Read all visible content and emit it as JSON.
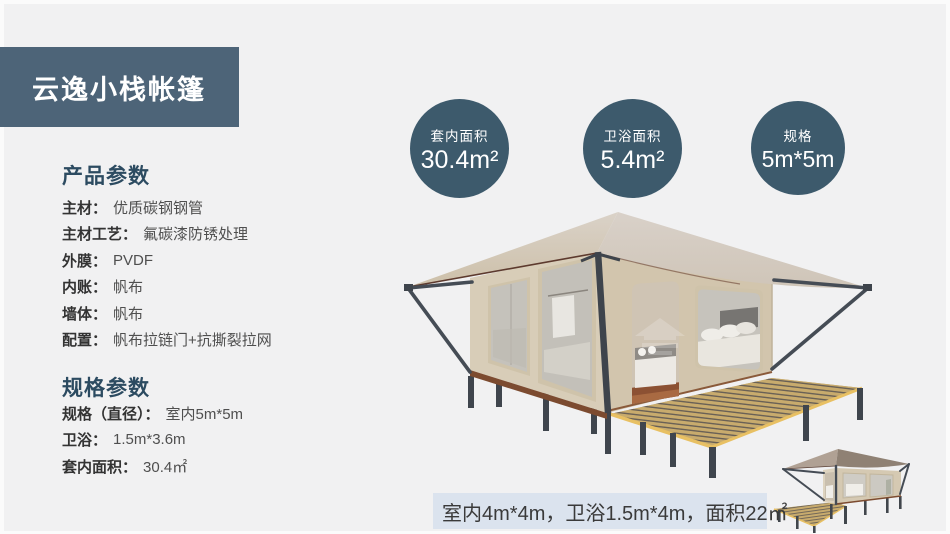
{
  "banner": {
    "title": "云逸小栈帐篷"
  },
  "product_params": {
    "heading": "产品参数",
    "items": [
      {
        "label": "主材：",
        "value": "优质碳钢钢管"
      },
      {
        "label": "主材工艺：",
        "value": "氟碳漆防锈处理"
      },
      {
        "label": "外膜：",
        "value": "PVDF"
      },
      {
        "label": "内账：",
        "value": "帆布"
      },
      {
        "label": "墙体：",
        "value": "帆布"
      },
      {
        "label": "配置：",
        "value": "帆布拉链门+抗撕裂拉网"
      }
    ]
  },
  "spec_params": {
    "heading": "规格参数",
    "items": [
      {
        "label": "规格（直径）：",
        "value": "室内5m*5m"
      },
      {
        "label": "卫浴：",
        "value": "1.5m*3.6m"
      },
      {
        "label": "套内面积：",
        "value": "30.4㎡"
      }
    ]
  },
  "badges": [
    {
      "label": "套内面积",
      "value": "30.4m²"
    },
    {
      "label": "卫浴面积",
      "value": "5.4m²"
    },
    {
      "label": "规格",
      "value": "5m*5m"
    }
  ],
  "caption": {
    "text": "室内4m*4m，卫浴1.5m*4m，面积22㎡"
  },
  "colors": {
    "page_bg": "#f1f1f2",
    "frame": "#fbfbfb",
    "banner_bg": "#4d6478",
    "banner_text": "#ffffff",
    "badge_bg": "#3d5a6c",
    "badge_text": "#ffffff",
    "heading_text": "#2c4b61",
    "label_text": "#333333",
    "value_text": "#4f4f4f",
    "caption_bg": "#dbe3ee",
    "caption_text": "#3a3a3a"
  }
}
